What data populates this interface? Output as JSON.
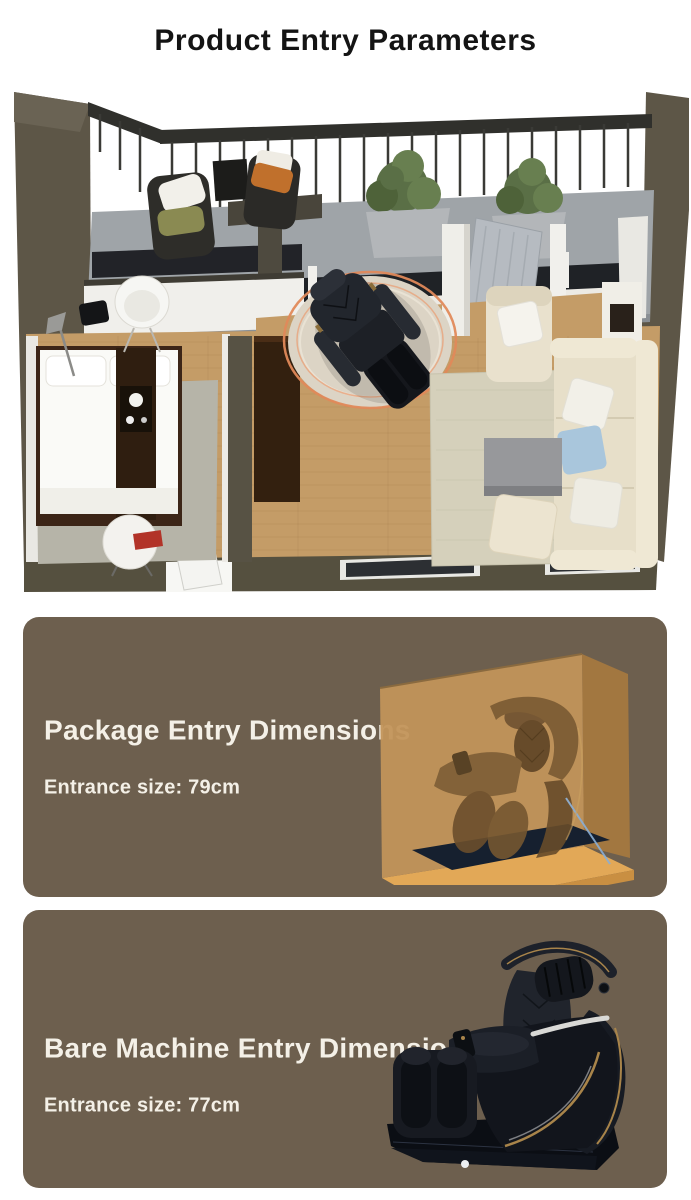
{
  "page": {
    "title": "Product Entry Parameters"
  },
  "floorplan": {
    "highlight_color": "#e0895a"
  },
  "cards": [
    {
      "title": "Package Entry Dimensions",
      "subtitle": "Entrance size: 79cm"
    },
    {
      "title": "Bare Machine Entry Dimensions",
      "subtitle": "Entrance size: 77cm"
    }
  ],
  "colors": {
    "title_text": "#141414",
    "card_background": "#6d5f4e",
    "card_text": "#f4f0e7",
    "box_tan": "#c2945a",
    "box_base_orange": "#e2a857",
    "chair_black": "#12151c",
    "gold_trim": "#a8844a"
  }
}
